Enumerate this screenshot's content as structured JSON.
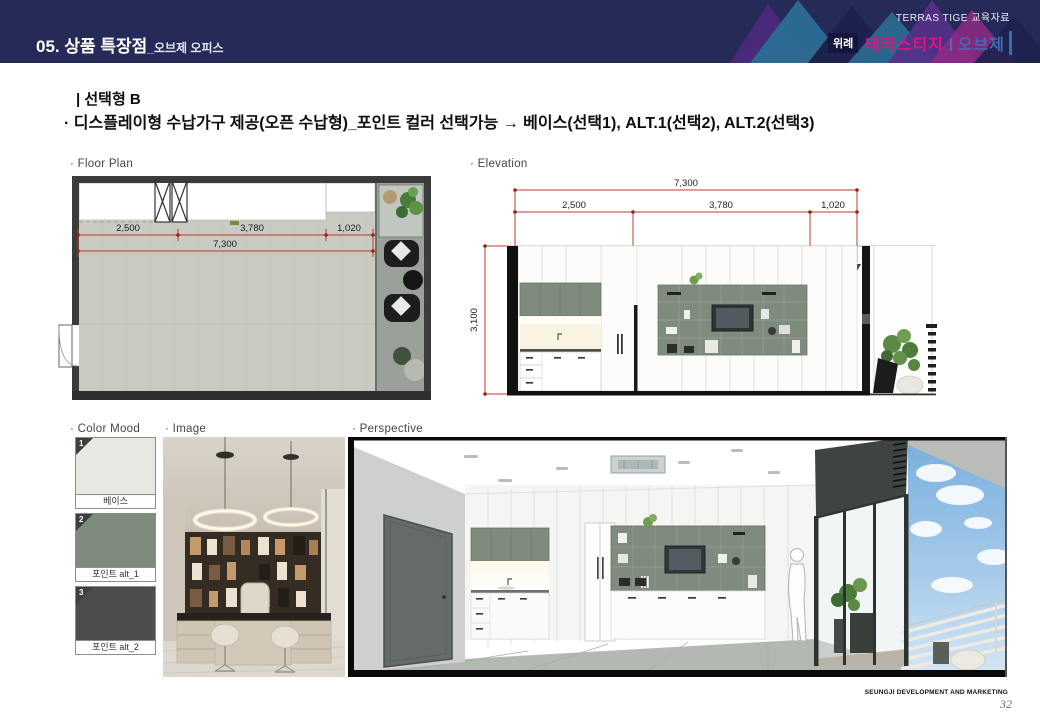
{
  "header": {
    "title": "05. 상품 특장점",
    "subtitle": "_오브제 오피스",
    "brand_top": "TERRAS TIGE 교육자료",
    "brand_prefix": "위례",
    "brand_name": "테라스티지",
    "brand_sep": "|",
    "brand_suffix": "오브제",
    "bg_color": "#262a58",
    "brand_name_color": "#e5127d",
    "brand_suffix_color": "#3f6cb4"
  },
  "headline": {
    "section_title": "|  선택형 B",
    "description": "· 디스플레이형 수납가구 제공(오픈 수납형)_포인트 컬러 선택가능 → 베이스(선택1), ALT.1(선택2), ALT.2(선택3)"
  },
  "floor_plan": {
    "label": "· Floor Plan",
    "dims": {
      "d1": "2,500",
      "d2": "3,780",
      "d3": "1,020",
      "total": "7,300"
    },
    "dim_color": "#c0392b"
  },
  "elevation": {
    "label": "· Elevation",
    "dims": {
      "total": "7,300",
      "d1": "2,500",
      "d2": "3,780",
      "d3": "1,020",
      "height": "3,100"
    },
    "dim_color": "#c0392b",
    "accent_green": "#7e8b7d"
  },
  "color_mood": {
    "label": "· Color Mood",
    "swatches": [
      {
        "num": "1",
        "name": "베이스",
        "color": "#e8e7e2"
      },
      {
        "num": "2",
        "name": "포인트 alt_1",
        "color": "#7e8b7d"
      },
      {
        "num": "3",
        "name": "포인트 alt_2",
        "color": "#4b4d4a"
      }
    ]
  },
  "image_section": {
    "label": "· Image"
  },
  "perspective_section": {
    "label": "· Perspective"
  },
  "footer": {
    "company": "SEUNGJI DEVELOPMENT AND MARKETING",
    "page": "32"
  }
}
